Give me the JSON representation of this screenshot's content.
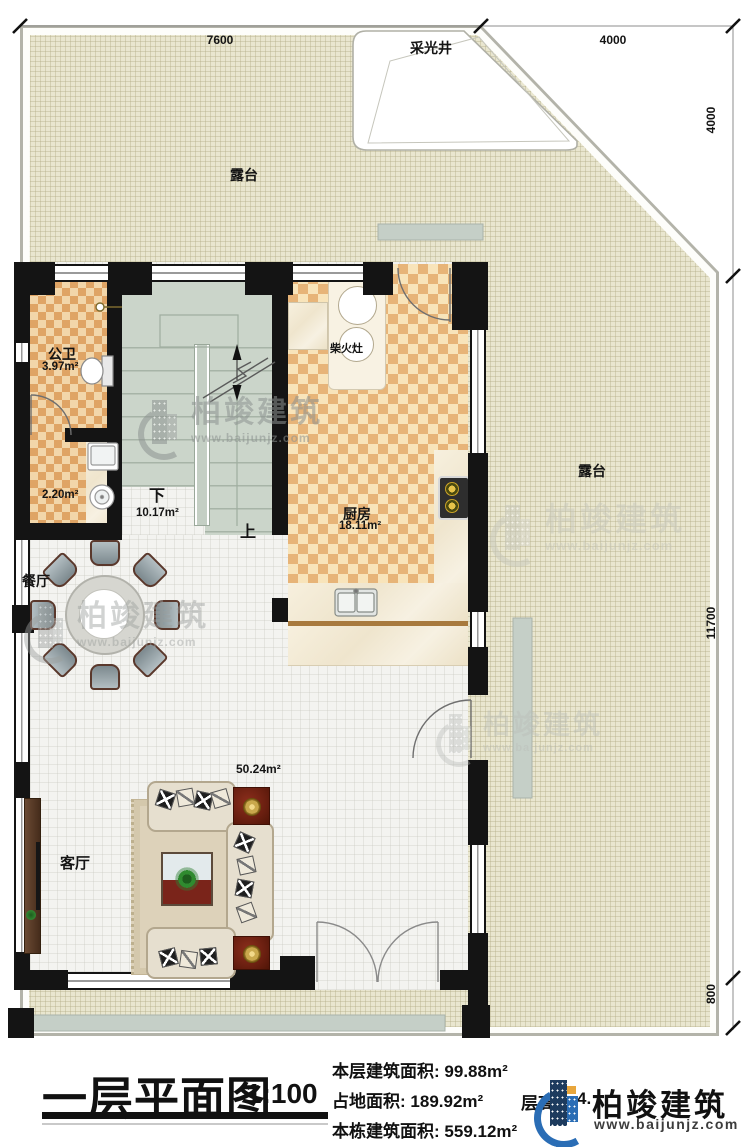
{
  "plan": {
    "title": "一层平面图",
    "scale": "1:100",
    "stats": [
      {
        "label": "本层建筑面积:",
        "value": "99.88m²"
      },
      {
        "label": "占地面积:",
        "value": "189.92m²"
      },
      {
        "label": "本栋建筑面积:",
        "value": "559.12m²"
      }
    ],
    "floor_height_label": "层高",
    "floor_height_value": "4.",
    "logo": {
      "name": "柏竣建筑",
      "url": "www.baijunjz.com"
    },
    "watermark": {
      "name": "柏竣建筑",
      "url": "www.baijunjz.com"
    },
    "colors": {
      "logo_navy": "#1d3b5e",
      "logo_blue": "#2a6db5",
      "logo_orange": "#e8a63c"
    },
    "dimensions": {
      "top_w1": "7600",
      "top_w2": "4000",
      "right_h1": "4000",
      "right_h2": "11700",
      "right_h3": "800"
    },
    "rooms": {
      "terrace_top": "露台",
      "terrace_right": "露台",
      "skylight": "采光井",
      "bathroom": {
        "name": "公卫",
        "area": "3.97m²"
      },
      "utility": {
        "area": "2.20m²"
      },
      "stairs": {
        "down": "下",
        "up": "上",
        "area": "10.17m²"
      },
      "kitchen": {
        "name": "厨房",
        "area": "18.11m²",
        "stove": "柴火灶"
      },
      "dining": {
        "name": "餐厅"
      },
      "living": {
        "name": "客厅",
        "area": "50.24m²"
      }
    }
  }
}
